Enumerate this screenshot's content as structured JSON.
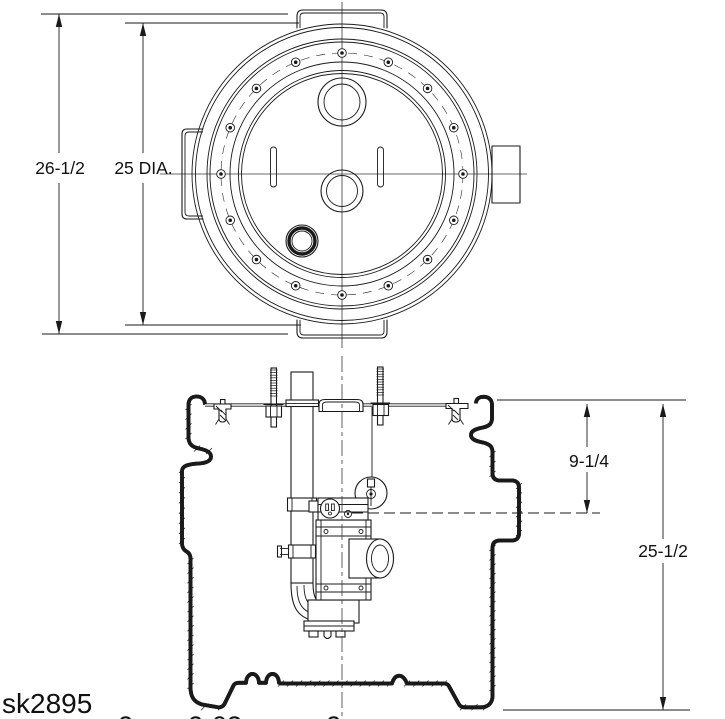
{
  "sheet_code": "sk2895",
  "dimensions": {
    "overall_height": "26-1/2",
    "cover_diameter": "25 DIA.",
    "inlet_invert_depth": "9-1/4",
    "basin_depth": "25-1/2"
  },
  "footer_partial": [
    "2",
    "2-03",
    "2"
  ],
  "colors": {
    "line": "#1a1a1a",
    "background": "#ffffff"
  }
}
